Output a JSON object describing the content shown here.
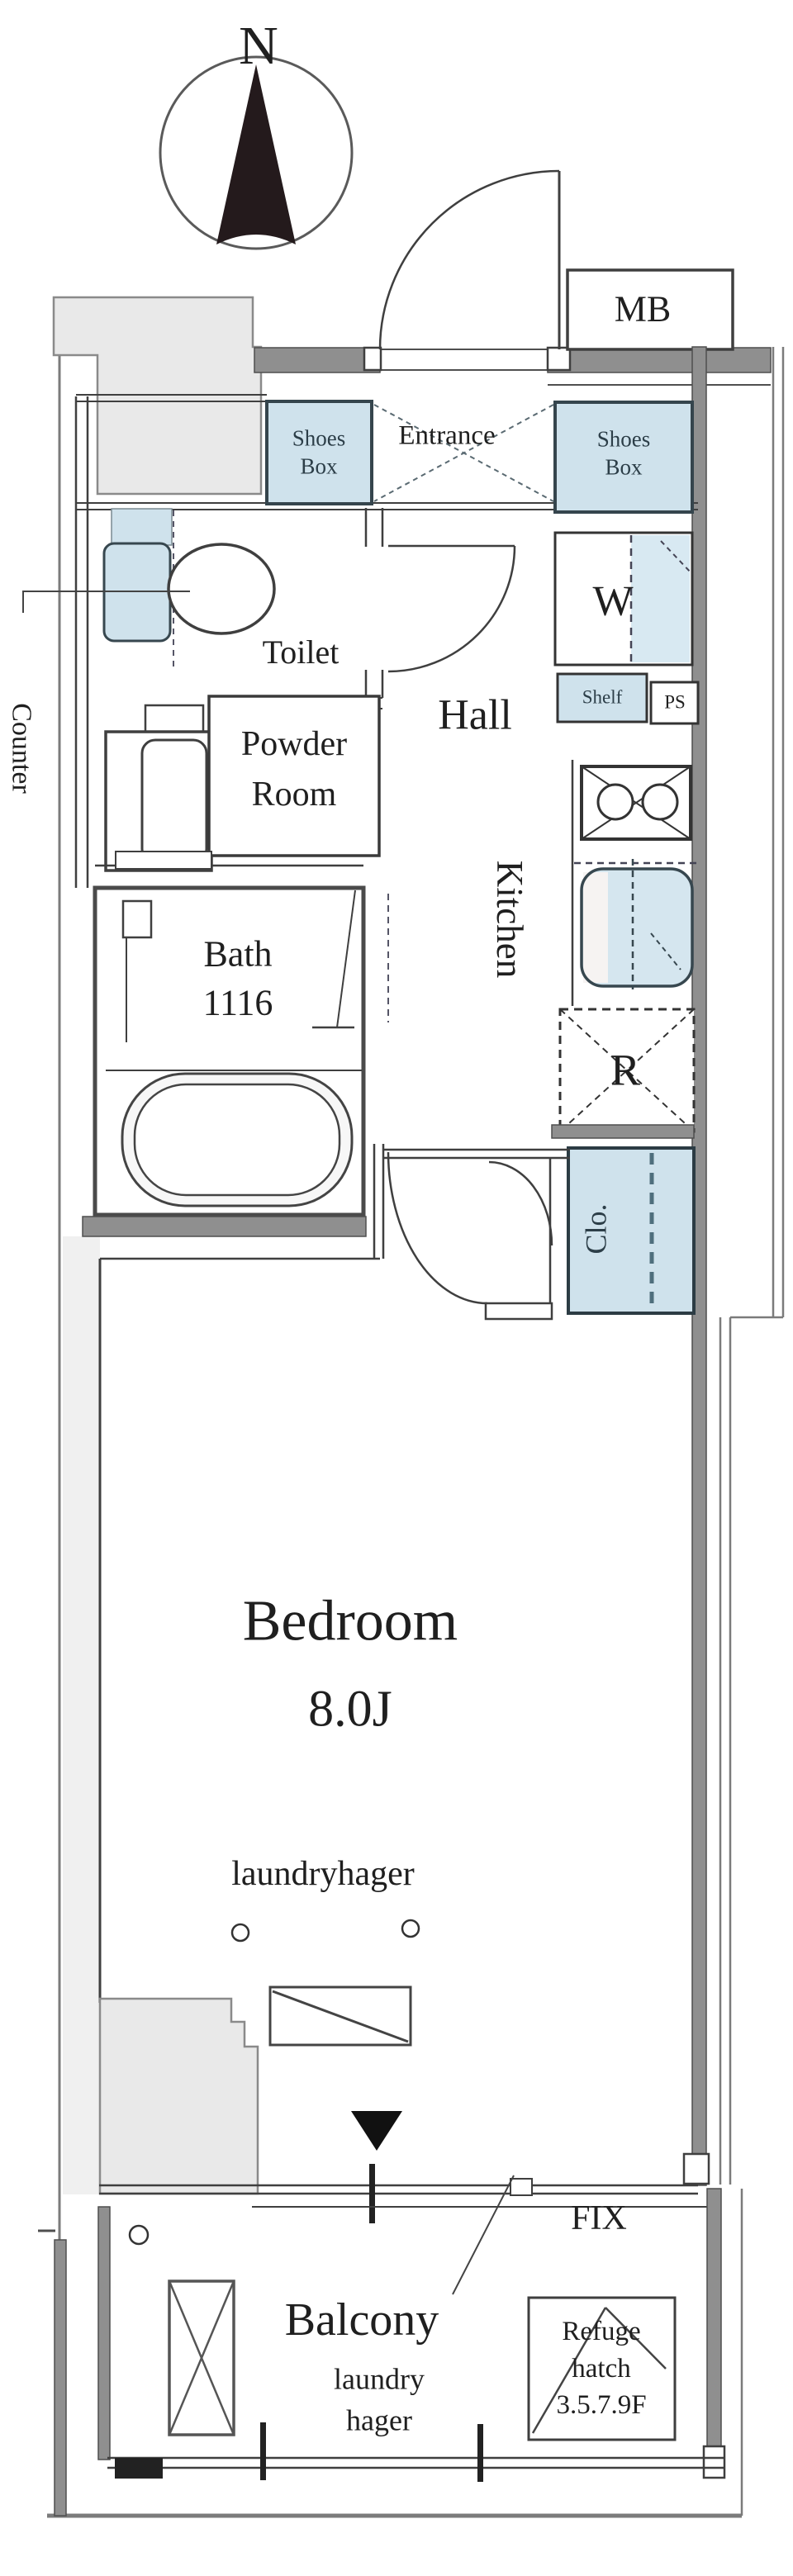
{
  "compass": {
    "north_label": "N"
  },
  "labels": {
    "mb": "MB",
    "entrance": "Entrance",
    "shoes_box_left": {
      "line1": "Shoes",
      "line2": "Box"
    },
    "shoes_box_right": {
      "line1": "Shoes",
      "line2": "Box"
    },
    "toilet": "Toilet",
    "washing_machine": "W",
    "shelf": "Shelf",
    "pipe_space": "PS",
    "hall": "Hall",
    "powder_room": {
      "line1": "Powder",
      "line2": "Room"
    },
    "kitchen": "Kitchen",
    "bath": {
      "line1": "Bath",
      "line2": "1116"
    },
    "refrigerator": "R",
    "closet": "Clo.",
    "counter": "Counter",
    "bedroom": {
      "name": "Bedroom",
      "size": "8.0J"
    },
    "laundry_hanger_bedroom": "laundryhager",
    "fix_window": "FIX",
    "balcony": "Balcony",
    "laundry_hanger_balcony": {
      "line1": "laundry",
      "line2": "hager"
    },
    "refuge_hatch": {
      "line1": "Refuge",
      "line2": "hatch",
      "line3": "3.5.7.9F"
    }
  },
  "colors": {
    "fixture_blue": "#cfe2ec",
    "wall_gray": "#8f8f8f",
    "block_gray": "#e9e9e9",
    "line_dark": "#3f3f3f"
  }
}
